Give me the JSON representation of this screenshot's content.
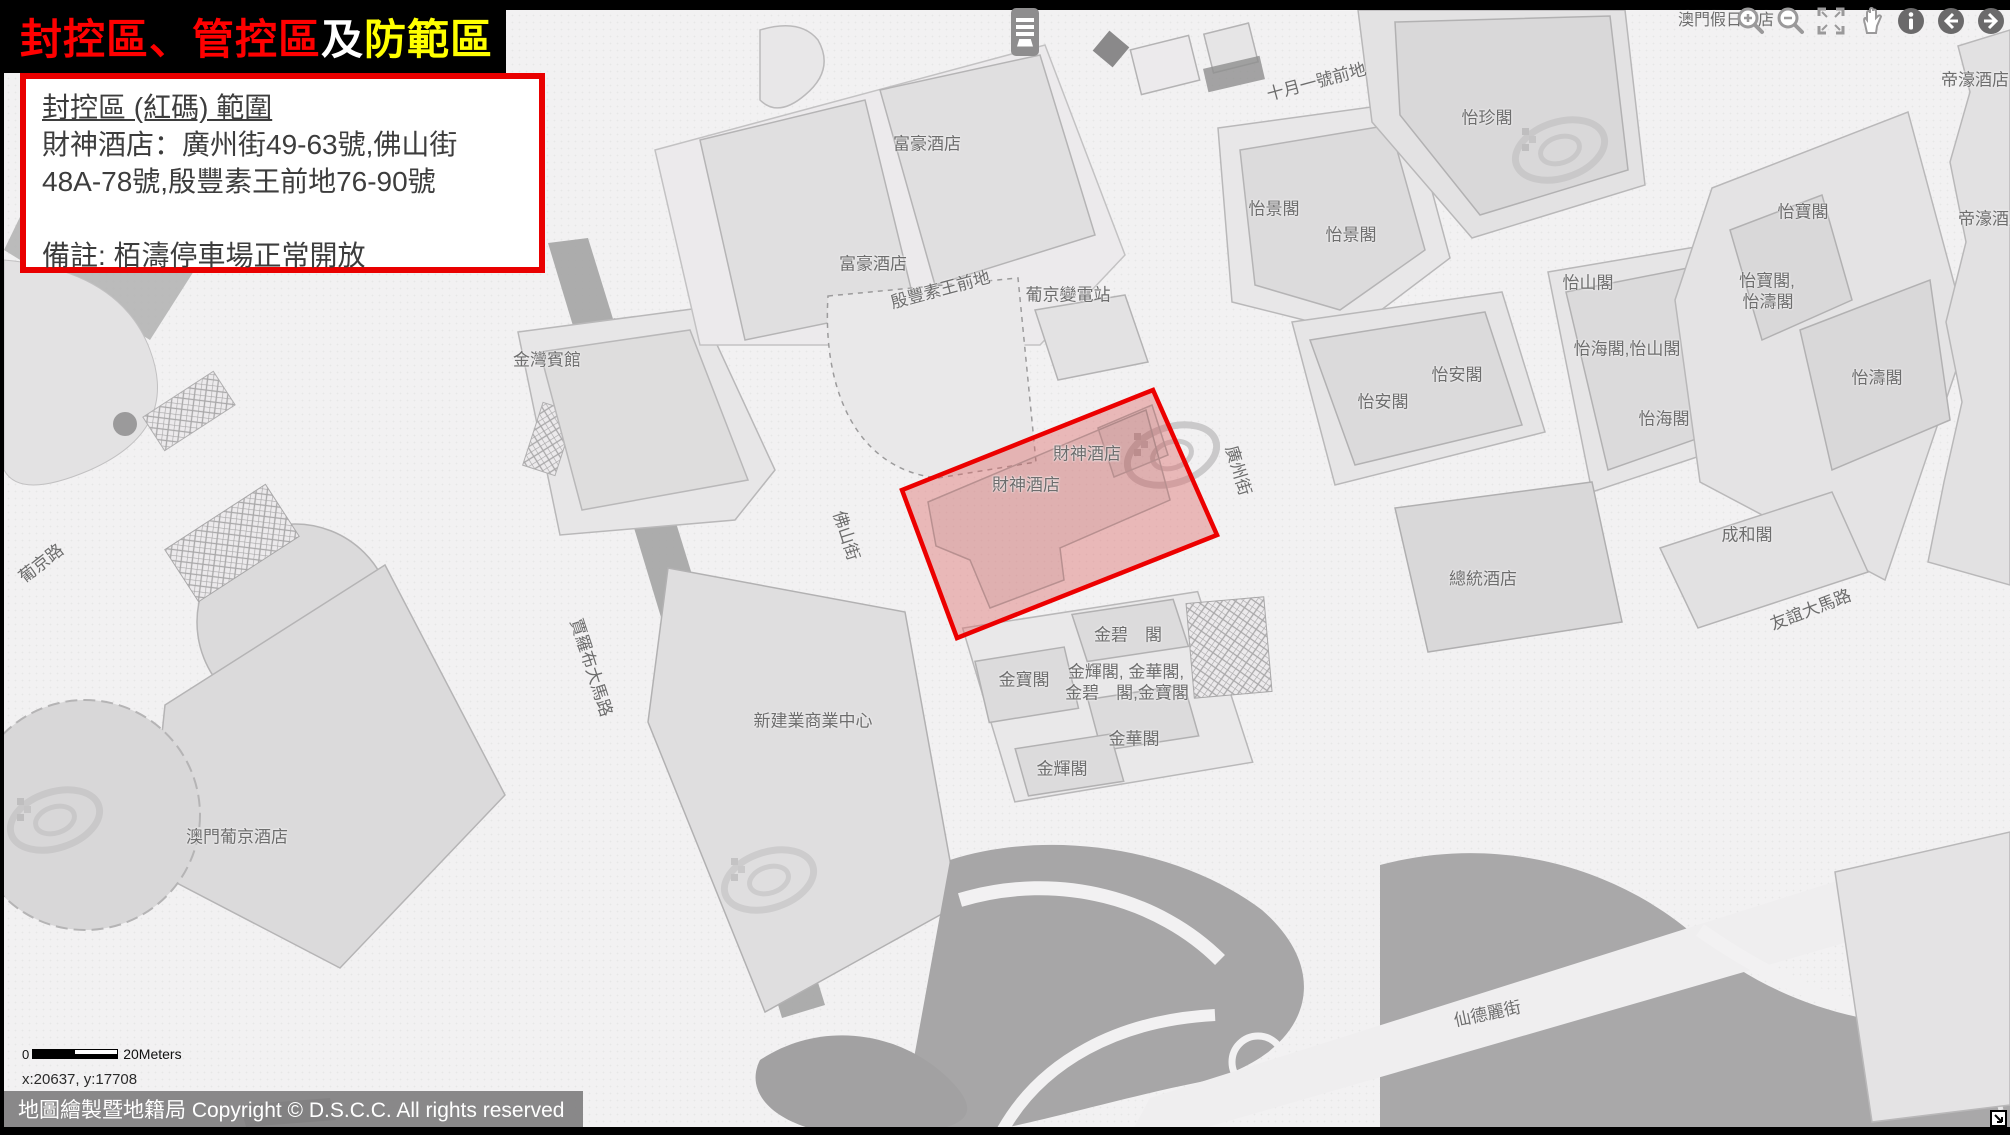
{
  "title": {
    "segments": [
      {
        "text": "封控區、管控區",
        "color": "#ff0000"
      },
      {
        "text": "及",
        "color": "#ffffff"
      },
      {
        "text": "防範區",
        "color": "#ffff00"
      }
    ]
  },
  "info_box": {
    "heading": "封控區 (紅碼) 範圍",
    "line1": "財神酒店：廣州街49-63號,佛山街",
    "line2": "48A-78號,殷豐素王前地76-90號",
    "note": "備註: 栢濤停車場正常開放"
  },
  "controls": {
    "icons": [
      {
        "name": "zoom-in-icon"
      },
      {
        "name": "zoom-out-icon"
      },
      {
        "name": "fullscreen-icon"
      },
      {
        "name": "pan-hand-icon"
      },
      {
        "name": "info-icon"
      },
      {
        "name": "back-icon"
      },
      {
        "name": "forward-icon"
      }
    ],
    "layers_button": "layers-icon",
    "corner_button": "resize-corner-icon"
  },
  "map": {
    "red_zone": {
      "points": "1153,390 1217,535 957,638 902,490",
      "fill": "#dd6a6a",
      "fill_opacity": "0.42",
      "border_color": "#ec0000"
    },
    "labels": [
      {
        "text": "澳門假日酒店",
        "x": 1726,
        "y": 18,
        "fs": 16
      },
      {
        "text": "帝濠酒店",
        "x": 1975,
        "y": 78
      },
      {
        "text": "帝濠酒店",
        "x": 1992,
        "y": 217
      },
      {
        "text": "十月一號前地",
        "x": 1316,
        "y": 80,
        "rot": -15
      },
      {
        "text": "怡珍閣",
        "x": 1487,
        "y": 116
      },
      {
        "text": "富豪酒店",
        "x": 927,
        "y": 142
      },
      {
        "text": "怡景閣",
        "x": 1274,
        "y": 207
      },
      {
        "text": "怡寶閣",
        "x": 1803,
        "y": 210
      },
      {
        "text": "怡景閣",
        "x": 1351,
        "y": 233
      },
      {
        "text": "富豪酒店",
        "x": 873,
        "y": 262
      },
      {
        "text": "怡寶閣,",
        "x": 1767,
        "y": 279
      },
      {
        "text": "怡山閣",
        "x": 1588,
        "y": 281
      },
      {
        "text": "殷豐素王前地",
        "x": 940,
        "y": 288,
        "rot": -15
      },
      {
        "text": "葡京變電站",
        "x": 1068,
        "y": 293
      },
      {
        "text": "怡濤閣",
        "x": 1768,
        "y": 300
      },
      {
        "text": "怡海閣,怡山閣",
        "x": 1627,
        "y": 347
      },
      {
        "text": "金灣賓館",
        "x": 547,
        "y": 358
      },
      {
        "text": "怡安閣",
        "x": 1457,
        "y": 373
      },
      {
        "text": "怡濤閣",
        "x": 1877,
        "y": 376
      },
      {
        "text": "怡安閣",
        "x": 1383,
        "y": 400
      },
      {
        "text": "怡海閣",
        "x": 1664,
        "y": 417
      },
      {
        "text": "財神酒店",
        "x": 1087,
        "y": 452
      },
      {
        "text": "廣州街",
        "x": 1240,
        "y": 470,
        "rot": 73
      },
      {
        "text": "財神酒店",
        "x": 1026,
        "y": 483
      },
      {
        "text": "成和閣",
        "x": 1747,
        "y": 533
      },
      {
        "text": "佛山街",
        "x": 848,
        "y": 535,
        "rot": 72
      },
      {
        "text": "葡京路",
        "x": 40,
        "y": 562,
        "rot": -38
      },
      {
        "text": "總統酒店",
        "x": 1483,
        "y": 577
      },
      {
        "text": "友誼大馬路",
        "x": 1810,
        "y": 608,
        "rot": -21
      },
      {
        "text": "金碧　閣",
        "x": 1128,
        "y": 633
      },
      {
        "text": "賈羅布大馬路",
        "x": 593,
        "y": 667,
        "rot": 72
      },
      {
        "text": "金輝閣, 金華閣,",
        "x": 1126,
        "y": 670
      },
      {
        "text": "金寶閣",
        "x": 1024,
        "y": 678
      },
      {
        "text": "金碧　閣,金寶閣",
        "x": 1127,
        "y": 691
      },
      {
        "text": "新建業商業中心",
        "x": 813,
        "y": 719
      },
      {
        "text": "金華閣",
        "x": 1134,
        "y": 737
      },
      {
        "text": "金輝閣",
        "x": 1062,
        "y": 767
      },
      {
        "text": "澳門葡京酒店",
        "x": 237,
        "y": 835
      },
      {
        "text": "仙德麗街",
        "x": 1487,
        "y": 1012,
        "rot": -12
      }
    ]
  },
  "scale_bar": {
    "zero": "0",
    "label": "20Meters"
  },
  "coordinates": "x:20637, y:17708",
  "copyright": "地圖繪製暨地籍局 Copyright © D.S.C.C. All rights reserved",
  "colors": {
    "lockdown_border": "#ec0000",
    "title_red": "#ff0000",
    "title_yellow": "#ffff00",
    "map_street": "#f2f1f2",
    "map_block": "#e8e7e8",
    "map_building": "#dddcdd"
  }
}
